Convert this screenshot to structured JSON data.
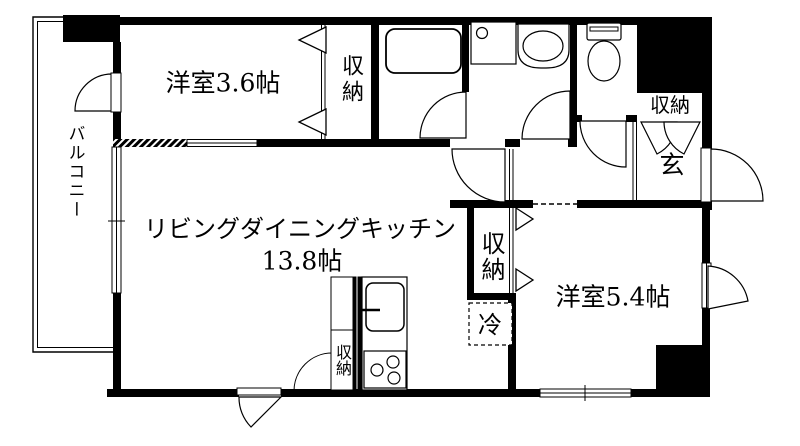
{
  "floorplan": {
    "labels": {
      "bedroom_36": "洋室3.6帖",
      "closet_bedroom36": "収納",
      "ldk_line1": "リビングダイニングキッチン",
      "ldk_line2": "13.8帖",
      "bedroom_54": "洋室5.4帖",
      "closet_bedroom54": "収納",
      "closet_kitchen": "収納",
      "closet_entrance": "収納",
      "balcony": "バルコニー",
      "entrance": "玄",
      "refrigerator": "冷"
    },
    "fixtures": [
      "bathtub",
      "washing-machine-pan",
      "wash-basin",
      "toilet",
      "kitchen-sink",
      "stove"
    ],
    "colors": {
      "wall": "#000000",
      "background": "#ffffff",
      "line": "#000000"
    }
  }
}
